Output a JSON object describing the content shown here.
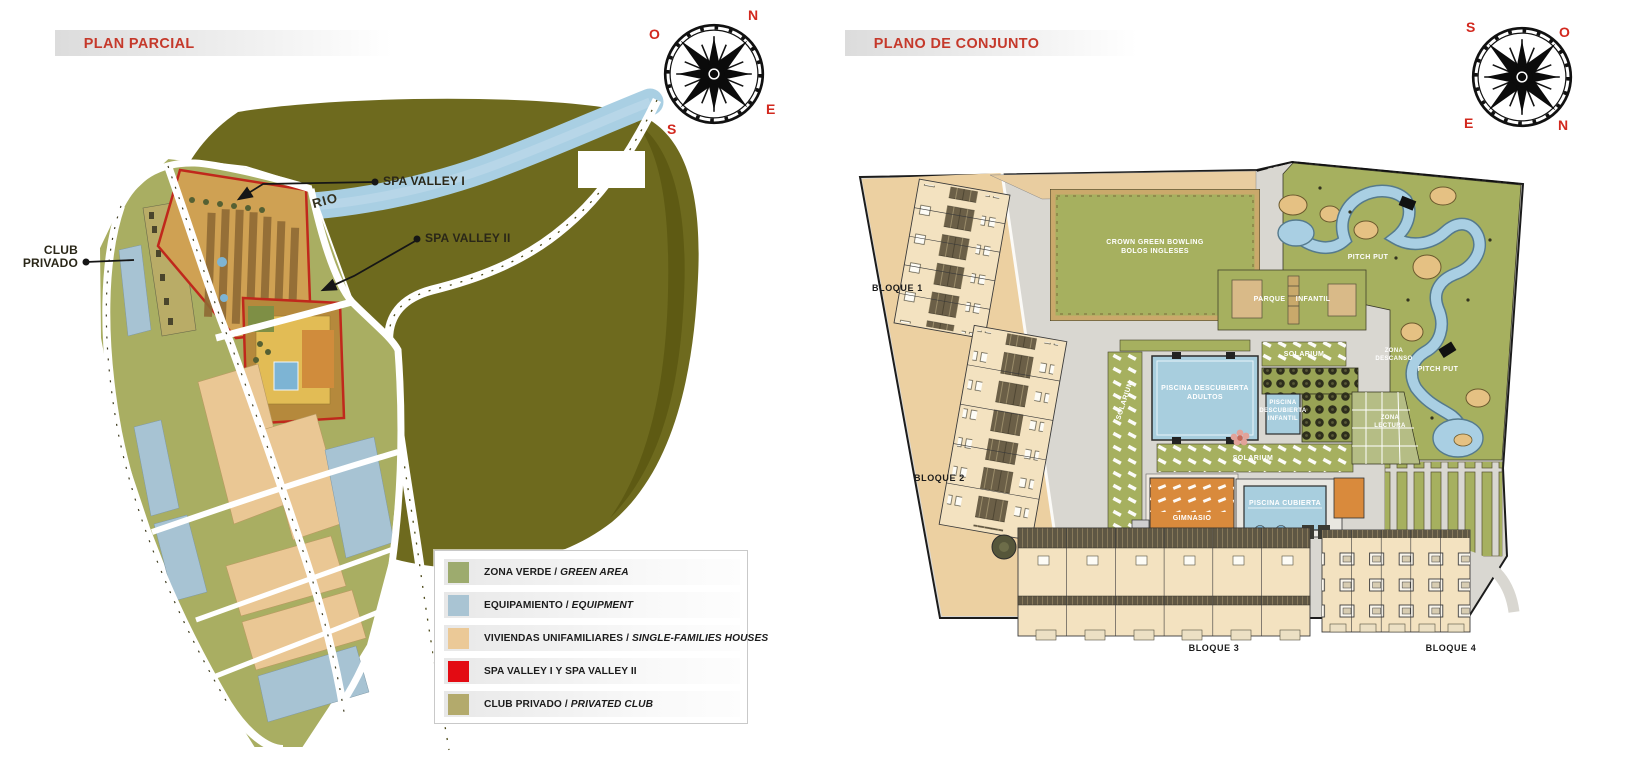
{
  "left_panel": {
    "title": "PLAN PARCIAL",
    "compass": {
      "top_right": "N",
      "top_left": "O",
      "bottom_right": "E",
      "bottom_left": "S"
    },
    "labels": {
      "spa_valley_1": "SPA VALLEY I",
      "spa_valley_2": "SPA VALLEY II",
      "club_privado": "CLUB PRIVADO",
      "rio": "RIO"
    },
    "legend": [
      {
        "label": "ZONA VERDE / ",
        "label_en": "GREEN AREA",
        "color": "#9dab6e"
      },
      {
        "label": "EQUIPAMIENTO / ",
        "label_en": "EQUIPMENT",
        "color": "#a9c4d3"
      },
      {
        "label": "VIVIENDAS UNIFAMILIARES / ",
        "label_en": "SINGLE-FAMILIES HOUSES",
        "color": "#ebc997"
      },
      {
        "label": "SPA VALLEY I Y SPA VALLEY II",
        "label_en": "",
        "color": "#e30b13"
      },
      {
        "label": "CLUB PRIVADO / ",
        "label_en": "PRIVATED CLUB",
        "color": "#b3aa6c"
      }
    ]
  },
  "right_panel": {
    "title": "PLANO DE CONJUNTO",
    "compass": {
      "top_left": "S",
      "top_right": "O",
      "bottom_left": "E",
      "bottom_right": "N"
    },
    "labels": {
      "bloque_1": "BLOQUE 1",
      "bloque_2": "BLOQUE 2",
      "bloque_3": "BLOQUE 3",
      "bloque_4": "BLOQUE 4",
      "bowling": {
        "l1": "CROWN GREEN BOWLING",
        "l2": "BOLOS INGLESES"
      },
      "parque_infantil": "PARQUE INFANTIL",
      "solarium": "SOLARIUM",
      "piscina_adultos": {
        "l1": "PISCINA DESCUBIERTA",
        "l2": "ADULTOS"
      },
      "piscina_infantil": {
        "l1": "PISCINA",
        "l2": "DESCUBIERTA",
        "l3": "INFANTIL"
      },
      "pitch_put": "PITCH PUT",
      "zona_descanso": {
        "l1": "ZONA",
        "l2": "DESCANSO"
      },
      "zona_lectura": {
        "l1": "ZONA",
        "l2": "LECTURA"
      },
      "gimnasio": "GIMNASIO",
      "piscina_cubierta": "PISCINA CUBIERTA"
    }
  },
  "colors": {
    "title_red": "#c5392b",
    "compass_letter_red": "#d2281e",
    "hill_olive": "#6e6a1e",
    "river_blue": "#a9cfe3",
    "green_area": "#a6b05f",
    "path_gray": "#d9d7d1",
    "building_tan": "#f3e2c0",
    "gym_orange": "#d98a3c",
    "pool_blue": "#a8cede"
  }
}
